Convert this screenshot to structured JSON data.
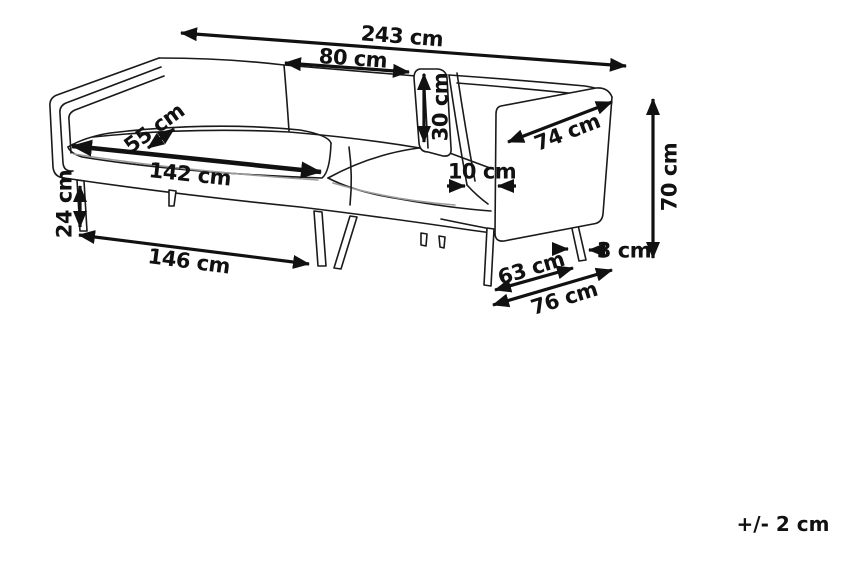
{
  "figure": {
    "name": "sofa-dimension-diagram",
    "description": "Line drawing of a three-seat sofa shown in perspective with dimension arrows",
    "unit": "cm"
  },
  "colors": {
    "background": "#ffffff",
    "outline": "#1a1a1a",
    "arrow": "#111111",
    "text": "#111111",
    "seam": "#9a9a9a"
  },
  "dimensions": {
    "overall_length": {
      "label": "243 cm",
      "value": 243
    },
    "backrest_cushion_width": {
      "label": "80 cm",
      "value": 80
    },
    "back_pillow_height": {
      "label": "30 cm",
      "value": 30
    },
    "armrest_panel_depth": {
      "label": "74 cm",
      "value": 74
    },
    "backrest_gap": {
      "label": "10 cm",
      "value": 10
    },
    "seat_width": {
      "label": "142 cm",
      "value": 142
    },
    "seat_depth": {
      "label": "55 cm",
      "value": 55
    },
    "leg_height": {
      "label": "24 cm",
      "value": 24
    },
    "base_length": {
      "label": "146 cm",
      "value": 146
    },
    "side_base_depth": {
      "label": "63 cm",
      "value": 63
    },
    "side_overall_depth": {
      "label": "76 cm",
      "value": 76
    },
    "leg_thickness": {
      "label": "3 cm",
      "value": 3
    },
    "overall_height": {
      "label": "70 cm",
      "value": 70
    }
  },
  "tolerance": {
    "label": "+/- 2 cm",
    "value": 2
  }
}
